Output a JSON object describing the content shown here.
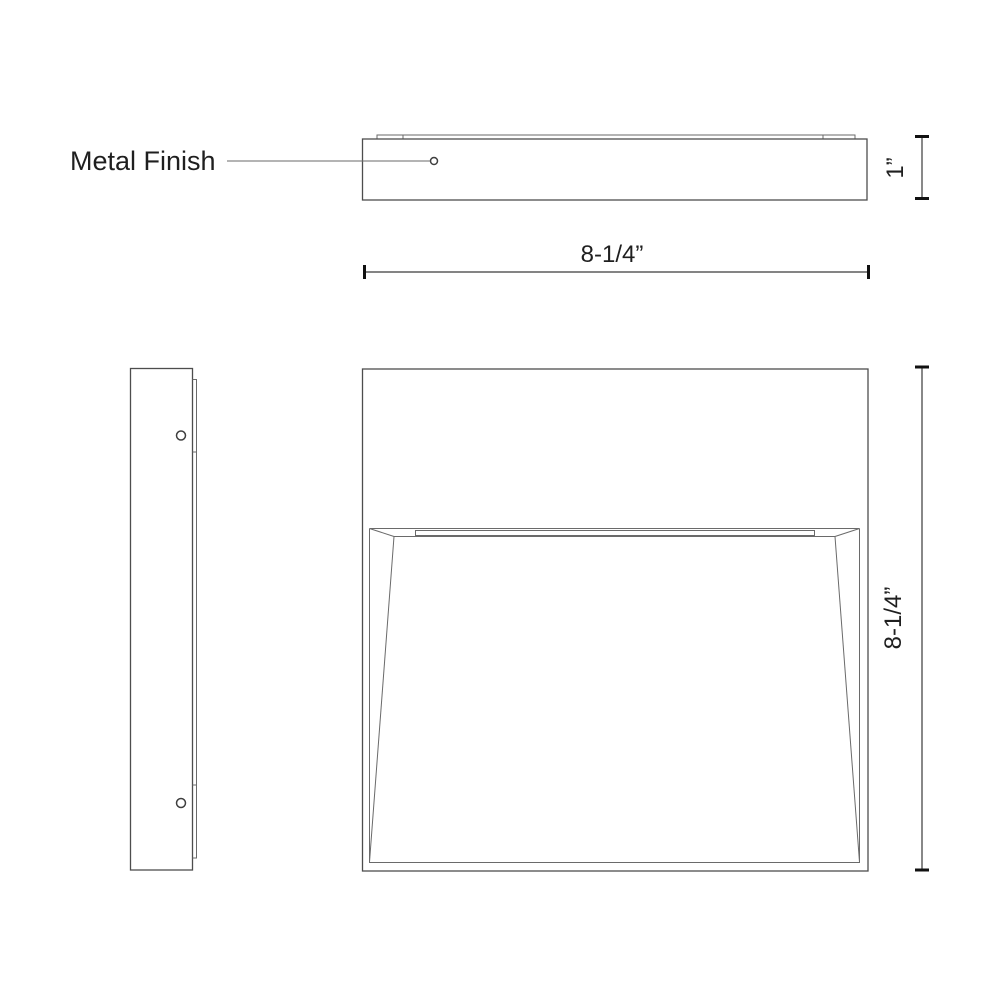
{
  "drawing": {
    "annotations": {
      "metal_finish": "Metal Finish"
    },
    "dimensions": {
      "depth": "1”",
      "width": "8-1/4”",
      "height": "8-1/4”"
    },
    "colors": {
      "background": "#ffffff",
      "outline": "#4d4d4d",
      "dimension_line": "#3a3a3a",
      "dimension_cap": "#111111",
      "text": "#1f1f1f"
    }
  }
}
